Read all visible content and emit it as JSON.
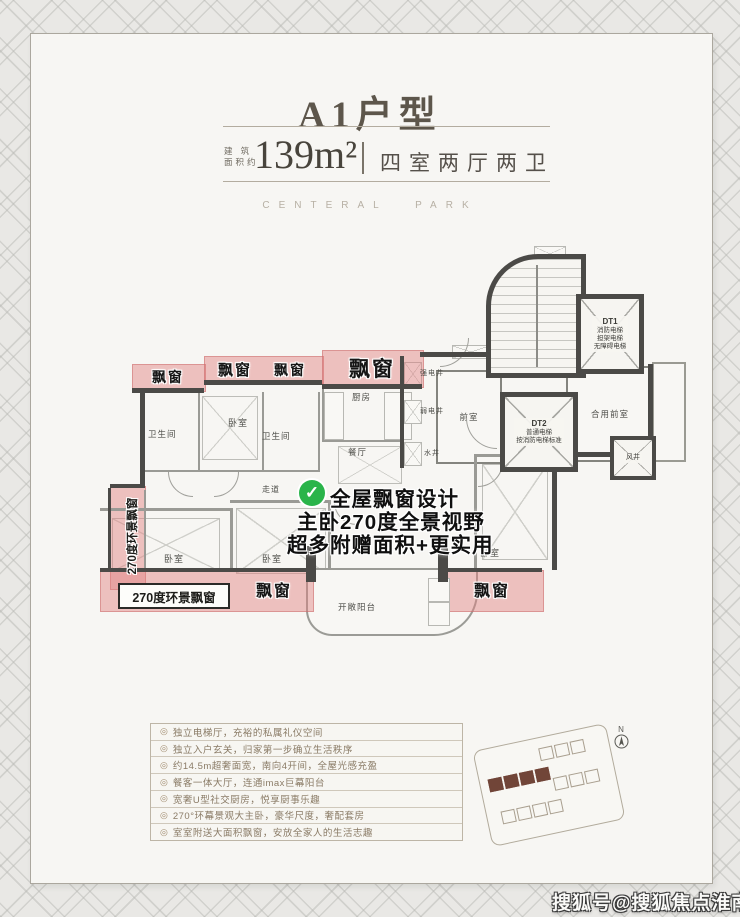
{
  "header": {
    "title": "A1户型",
    "area_label_line1": "建 筑",
    "area_label_line2": "面积约",
    "area_value": "139m²",
    "layout": "四室两厅两卫",
    "brand": "CENTERAL PARK"
  },
  "floorplan": {
    "bay_window": "飘窗",
    "panorama_bay": "270度环景飘窗",
    "annotation": {
      "check": "✓",
      "line1": "全屋飘窗设计",
      "line2": "主卧270度全景视野",
      "line3": "超多附赠面积+更实用"
    },
    "rooms": {
      "bathroom": "卫生间",
      "bedroom": "卧室",
      "kitchen": "厨房",
      "dining": "餐厅",
      "corridor": "走道",
      "open_balcony": "开敞阳台",
      "front_room": "前室",
      "shared_front_room": "合用前室",
      "strong_elec_shaft": "强电井",
      "weak_elec_shaft": "弱电井",
      "water_shaft": "水井",
      "wind_shaft": "风井"
    },
    "elevators": {
      "dt1": {
        "name": "DT1",
        "line1": "消防电梯",
        "line2": "担架电梯",
        "line3": "无障碍电梯"
      },
      "dt2": {
        "name": "DT2",
        "line1": "普通电梯",
        "line2": "按消防电梯标准"
      }
    }
  },
  "features": {
    "bullet": "◎",
    "items": [
      "独立电梯厅，充裕的私属礼仪空间",
      "独立入户玄关，归家第一步确立生活秩序",
      "约14.5m超奢面宽，南向4开间，全屋光感充盈",
      "餐客一体大厅，连通imax巨幕阳台",
      "宽奢U型社交厨房，悦享厨事乐趣",
      "270°环幕景观大主卧，豪华尺度，奢配套房",
      "室室附送大面积飘窗，安放全家人的生活志趣"
    ]
  },
  "siteplan": {
    "north": "N"
  },
  "watermark": {
    "text": "搜狐号@搜狐焦点淮南站"
  },
  "colors": {
    "bay_pink": "#e08080",
    "wall_dark": "#4b4a47",
    "check_green": "#2ab44a",
    "feature_text": "#8a7b66"
  }
}
